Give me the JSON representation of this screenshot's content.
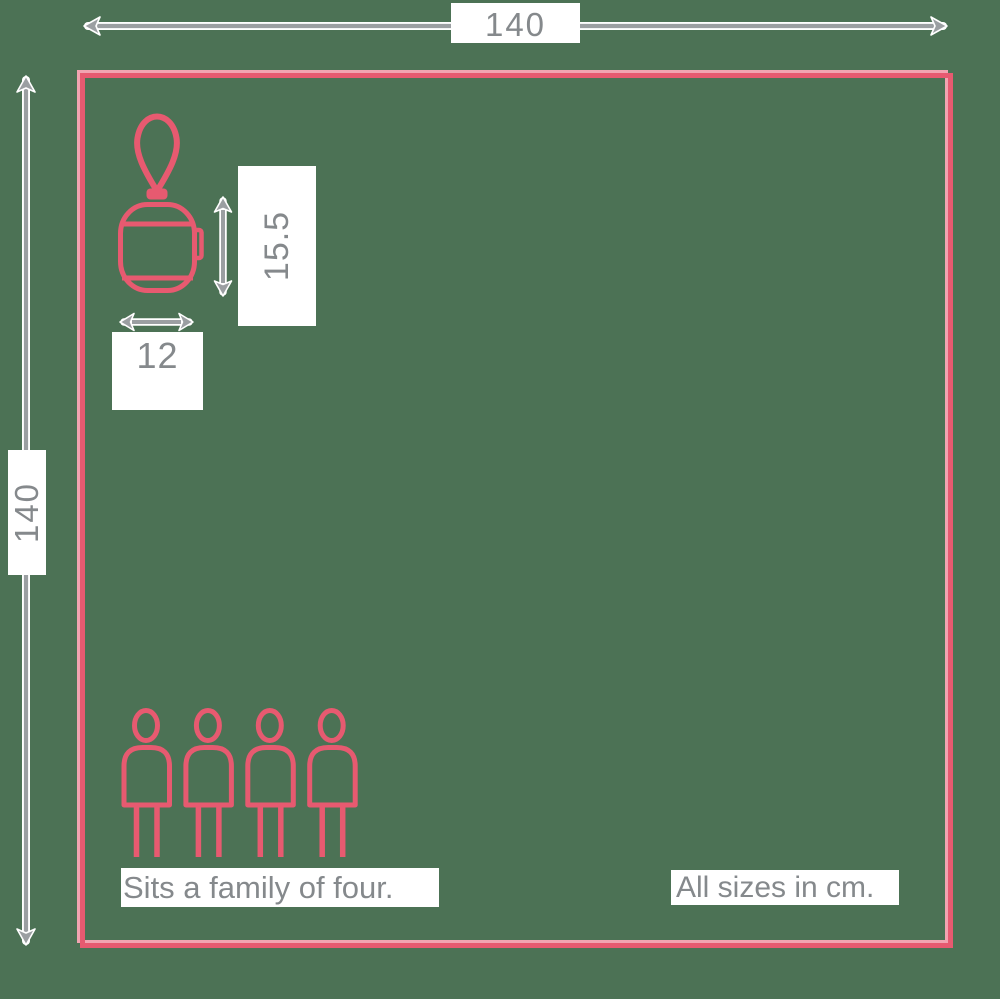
{
  "canvas": {
    "width": 1000,
    "height": 999
  },
  "colors": {
    "background": "#4c7255",
    "accent": "#e75a70",
    "accent_light": "#f2a4b1",
    "measure": "#9b9fa2",
    "text": "#85898c",
    "label_bg": "#ffffff"
  },
  "dimensions": {
    "overall_width": "140",
    "overall_height": "140",
    "item_height": "15.5",
    "item_width": "12"
  },
  "captions": {
    "capacity": "Sits a family of four.",
    "units": "All sizes in cm."
  },
  "icons": {
    "item": "lantern-icon",
    "people": "person-icon",
    "people_count": 4
  }
}
